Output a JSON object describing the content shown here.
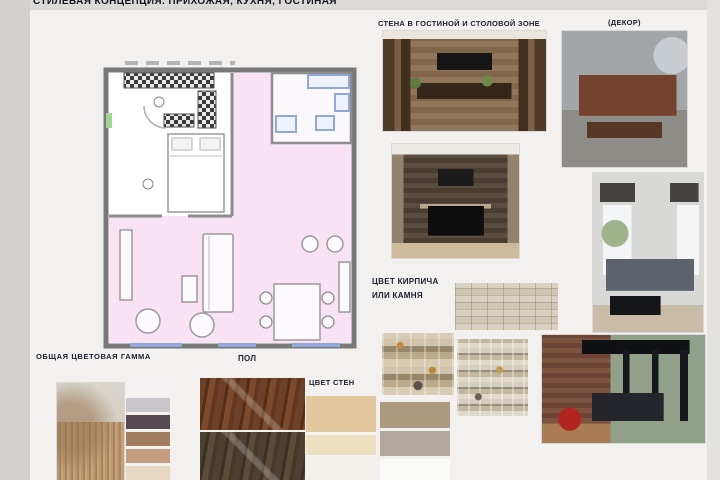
{
  "title": "СТИЛЕВАЯ КОНЦЕПЦИЯ. ПРИХОЖАЯ, КУХНЯ, ГОСТИНАЯ",
  "labels": {
    "wall_zone": "СТЕНА В ГОСТИНОЙ И СТОЛОВОЙ ЗОНЕ",
    "decor": "(ДЕКОР)",
    "brick_line1": "ЦВЕТ КИРПИЧА",
    "brick_line2": "ИЛИ КАМНЯ",
    "palette": "ОБЩАЯ ЦВЕТОВАЯ ГАММА",
    "floor": "ПОЛ",
    "walls": "ЦВЕТ СТЕН"
  },
  "palette": {
    "colors": [
      "#f3f1f2",
      "#c8c6cb",
      "#574b51",
      "#a47c60",
      "#c49d7e",
      "#e8d7c2"
    ]
  },
  "wall_colors": {
    "left": [
      "#e2c79f",
      "#eedfc1",
      "#f3f0ea"
    ],
    "right": [
      "#ab9a80",
      "#b2a99c",
      "#fafaf8"
    ]
  },
  "floor_woods": [
    "#6b3e26",
    "#45392c"
  ],
  "colors": {
    "board-bg": "#f2f1ef",
    "margin-bg": "#d2d1cf",
    "label-color": "#20202e",
    "plan-pink": "#f8e2f4",
    "plan-wall": "#787878",
    "plan-window": "#8fa9dd"
  }
}
